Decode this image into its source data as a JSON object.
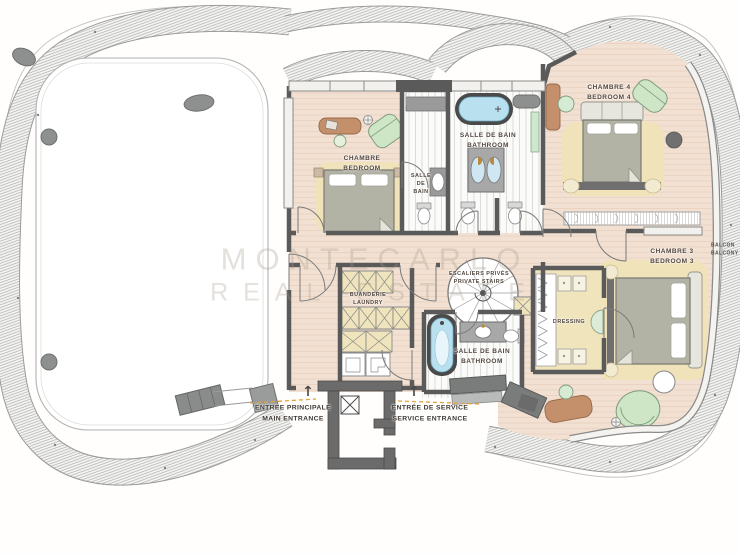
{
  "floorplan": {
    "watermark": {
      "line1": "MONTECARLO",
      "line2": "REAL ESTATE"
    },
    "rooms": {
      "bedroom": {
        "fr": "CHAMBRE",
        "en": "BEDROOM"
      },
      "bath_small": {
        "line1": "SALLE",
        "line2": "DE",
        "line3": "BAIN"
      },
      "bath_top": {
        "fr": "SALLE DE BAIN",
        "en": "BATHROOM"
      },
      "bedroom4": {
        "fr": "CHAMBRE 4",
        "en": "BEDROOM 4"
      },
      "bedroom3": {
        "fr": "CHAMBRE 3",
        "en": "BEDROOM 3"
      },
      "dressing": {
        "label": "DRESSING"
      },
      "private_stairs": {
        "fr": "ESCALIERS PRIVÉS",
        "en": "PRIVATE STAIRS"
      },
      "bath_lower": {
        "fr": "SALLE DE BAIN",
        "en": "BATHROOM"
      },
      "laundry": {
        "fr": "BUANDERIE",
        "en": "LAUNDRY"
      },
      "balcony": {
        "fr": "BALCON",
        "en": "BALCONY"
      }
    },
    "entrances": {
      "main": {
        "fr": "ENTREE PRINCIPALE",
        "en": "MAIN ENTRANCE",
        "arrow": "↑"
      },
      "service": {
        "fr": "ENTRÉE DE SERVICE",
        "en": "SERVICE ENTRANCE",
        "arrow": "↑"
      }
    },
    "colors": {
      "wood_floor": "#f2e1d2",
      "rug": "#f0e3ba",
      "wall": "#5a5a5a",
      "green_furniture": "#cfe6c6",
      "brown_furniture": "#c48f6b",
      "water": "#b8e0ee",
      "closet": "#f0e4bd",
      "entry_dashes": "#e2a23c",
      "steel_gray": "#8e9090"
    }
  }
}
